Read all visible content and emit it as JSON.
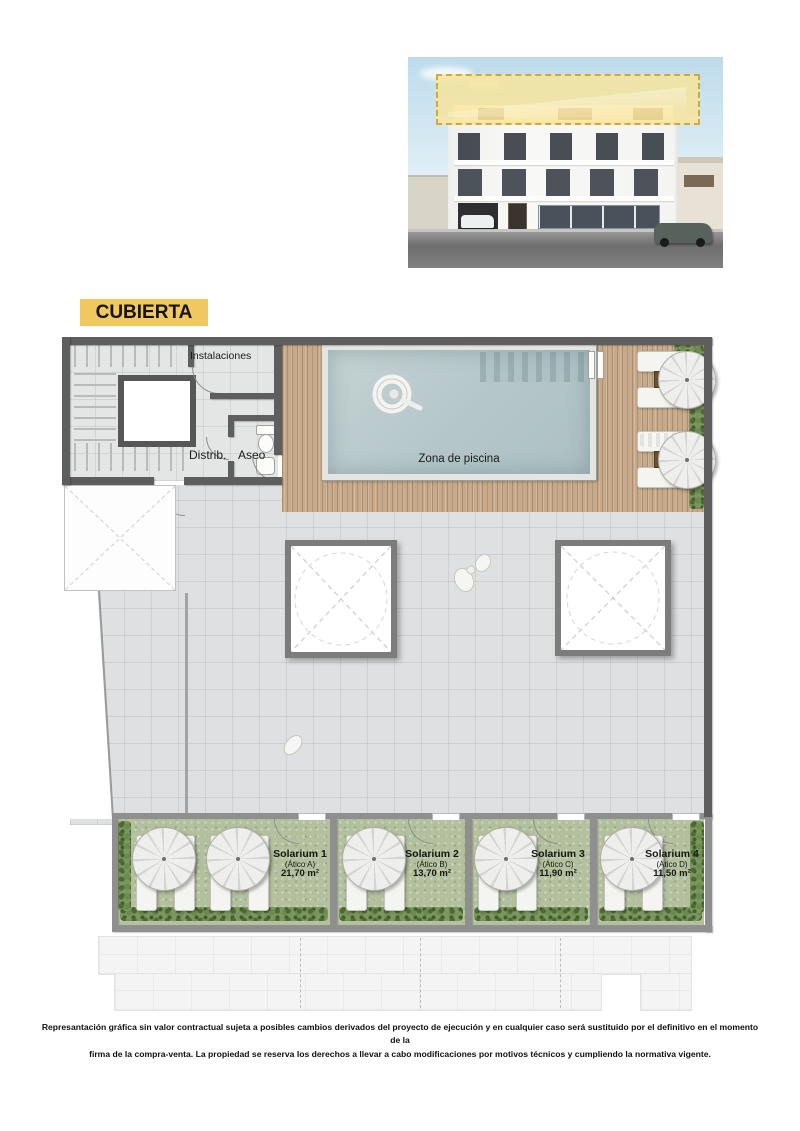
{
  "title": "CUBIERTA",
  "colors": {
    "accent_yellow": "#f1c75f",
    "wall_dark": "#5e5e5e",
    "wall_light": "#8f8f8f",
    "pool_water": "#b4c6c9",
    "wood_deck": "#c7aa89",
    "turf_green": "#b3c09d",
    "sky": "#bedbec"
  },
  "icons": {
    "umbrella-icon": "circle-with-spokes",
    "swim-ring-icon": "white-donut-with-figure",
    "toilet-icon": "bowl-and-tank",
    "sink-icon": "rounded-basin",
    "person-icon": "white-figure-blob",
    "ladder-icon": "two-rails"
  },
  "plan": {
    "rooms": {
      "instalaciones": "Instalaciones",
      "distrib": "Distrib.",
      "aseo": "Aseo",
      "pool": "Zona de piscina"
    },
    "solariums": [
      {
        "name": "Solarium 1",
        "atico": "(Ático A)",
        "area": "21,70 m²"
      },
      {
        "name": "Solarium 2",
        "atico": "(Ático B)",
        "area": "13,70 m²"
      },
      {
        "name": "Solarium 3",
        "atico": "(Ático C)",
        "area": "11,90 m²"
      },
      {
        "name": "Solarium 4",
        "atico": "(Ático D)",
        "area": "11,50 m²"
      }
    ]
  },
  "disclaimer": {
    "line1": "Represantación gráfica sin valor contractual sujeta a posibles cambios derivados del proyecto de ejecución y en cualquier caso será sustituido por el definitivo en el momento de la",
    "line2": "firma de la compra-venta. La propiedad se reserva los derechos a llevar a cabo modificaciones por motivos técnicos y cumpliendo la normativa vigente."
  }
}
